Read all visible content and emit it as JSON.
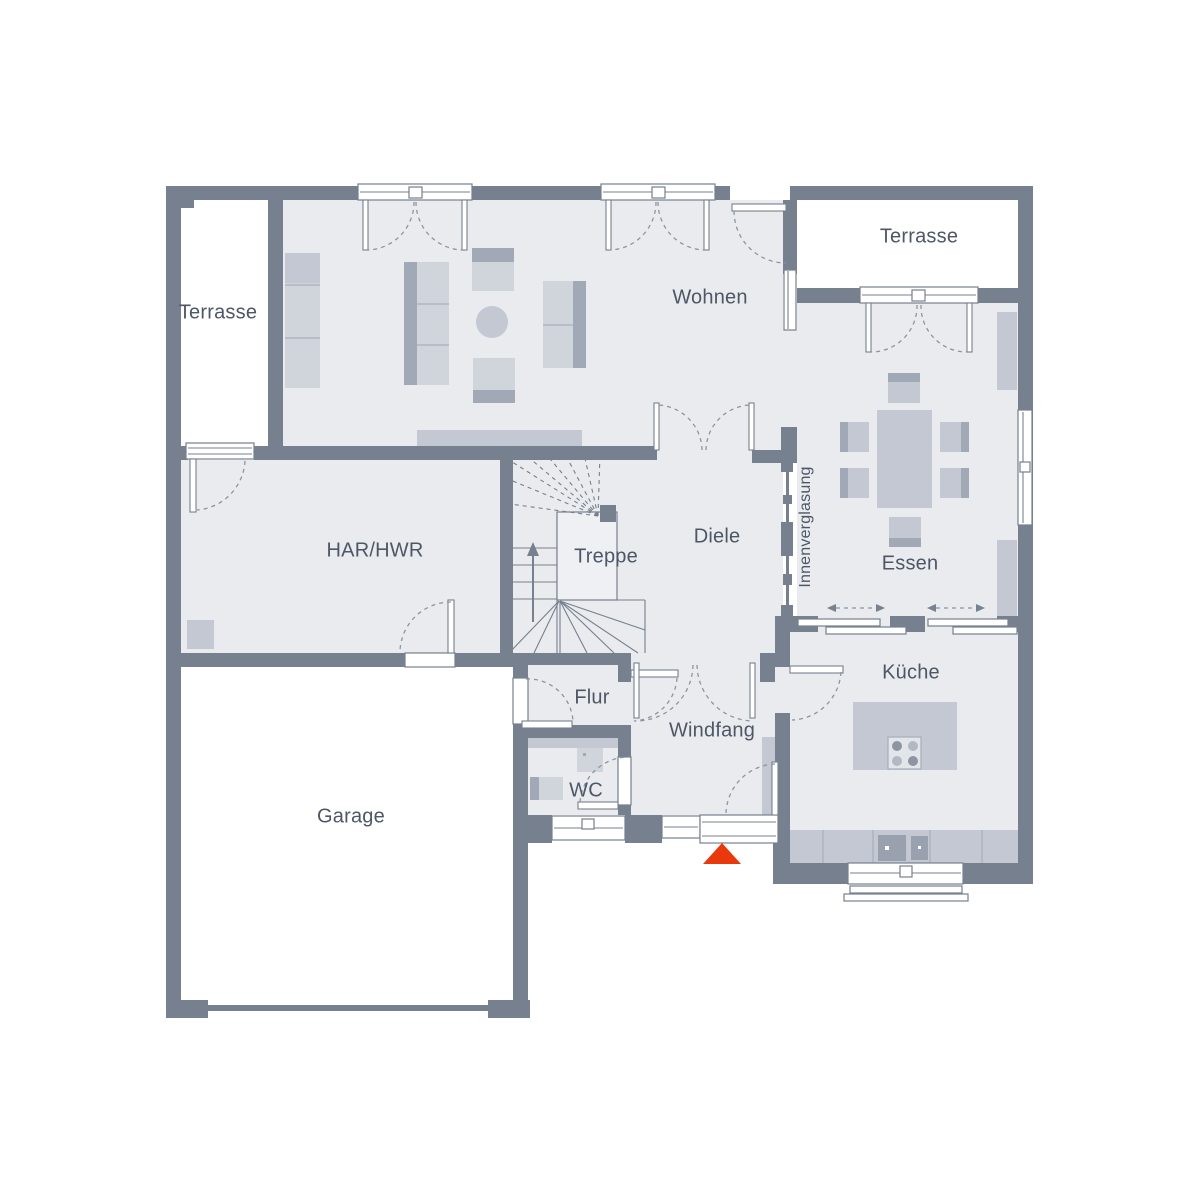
{
  "plan": {
    "type": "floor-plan",
    "rooms": {
      "terrasse_left": {
        "label": "Terrasse"
      },
      "terrasse_right": {
        "label": "Terrasse"
      },
      "wohnen": {
        "label": "Wohnen"
      },
      "har_hwr": {
        "label": "HAR/HWR"
      },
      "treppe": {
        "label": "Treppe"
      },
      "diele": {
        "label": "Diele"
      },
      "essen": {
        "label": "Essen"
      },
      "innenverglasung": {
        "label": "Innenverglasung"
      },
      "kueche": {
        "label": "Küche"
      },
      "flur": {
        "label": "Flur"
      },
      "windfang": {
        "label": "Windfang"
      },
      "wc": {
        "label": "WC"
      },
      "garage": {
        "label": "Garage"
      }
    },
    "icons": {
      "entrance_marker": "triangle-up-entrance-arrow",
      "stair_direction": "arrow-up",
      "sliding_door_markers": "double-headed-dashed-arrows"
    },
    "colors": {
      "wall": "#76808e",
      "floor": "#e9ebef",
      "furniture": "#d0d5dc",
      "furniture_mid": "#c3c8d2",
      "furniture_dark": "#a2a9b6",
      "line": "#8d95a3",
      "accent": "#e8380c",
      "text": "#4d5766"
    }
  }
}
